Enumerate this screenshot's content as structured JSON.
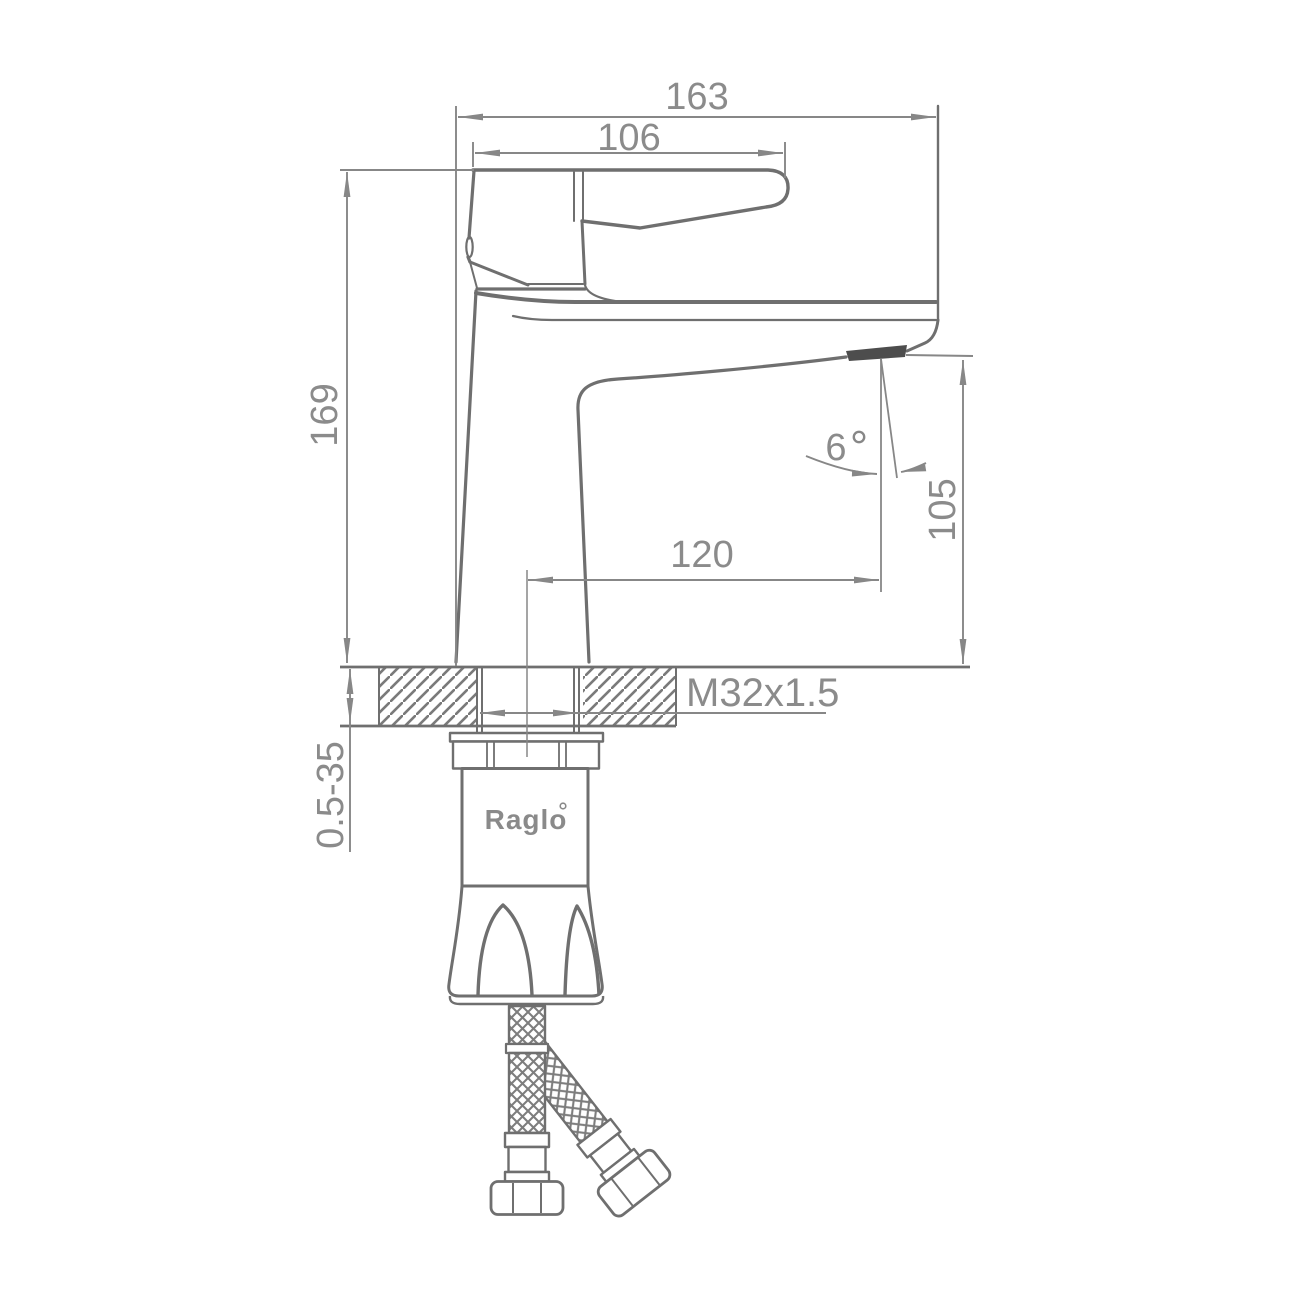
{
  "drawing": {
    "type": "technical-dimension-drawing",
    "subject": "single-handle basin faucet side view with flexible supply hoses",
    "brand": "Raglo",
    "labels": {
      "overall_length": "163",
      "handle_length": "106",
      "total_height": "169",
      "spout_reach": "120",
      "spout_outlet_height": "105",
      "spout_angle": "6",
      "thread_spec": "M32x1.5",
      "mounting_thickness_range": "0.5-35"
    },
    "colors": {
      "outline": "#6f6f6f",
      "dimension_line": "#878787",
      "text": "#8b8b8b",
      "aerator_fill": "#4d4d4d",
      "background": "#ffffff"
    }
  }
}
